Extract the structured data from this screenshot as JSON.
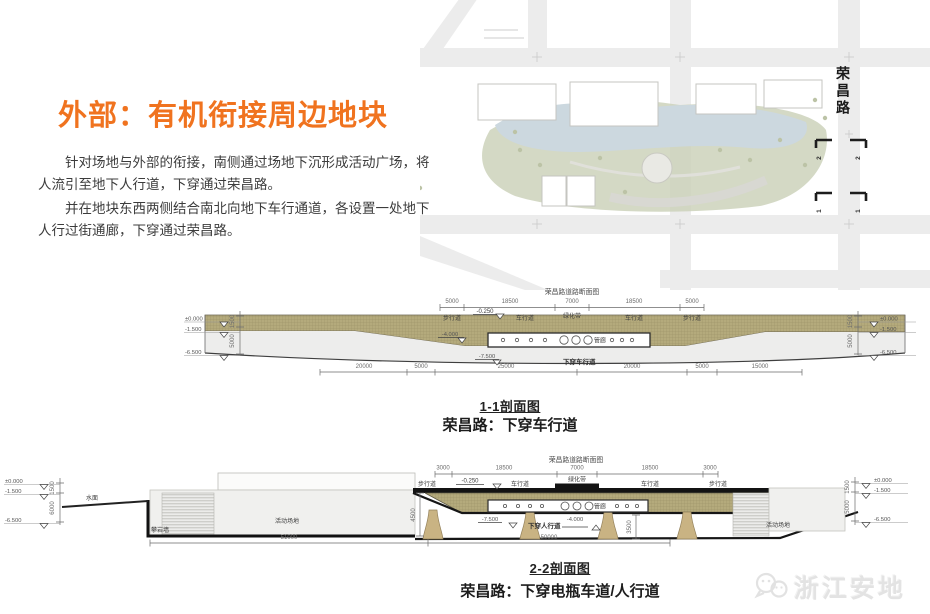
{
  "header": {
    "title": "外部：有机衔接周边地块",
    "para1": "针对场地与外部的衔接，南侧通过场地下沉形成活动广场，将人流引至地下人行道，下穿通过荣昌路。",
    "para2": "并在地块东西两侧结合南北向地下车行通道，各设置一处地下人行过街通廊，下穿通过荣昌路。"
  },
  "map": {
    "road_label": "荣昌路",
    "section_marker_2": "2",
    "section_marker_1": "1"
  },
  "section1": {
    "road_section_title": "荣昌路道路断面图",
    "top_dims": [
      "5000",
      "18500",
      "7000",
      "18500",
      "5000"
    ],
    "lanes": {
      "sidewalk_l": "步行道",
      "carriage_l": "车行道",
      "green": "绿化带",
      "carriage_r": "车行道",
      "sidewalk_r": "步行道"
    },
    "elev": {
      "zero": "±0.000",
      "m15": "-1.500",
      "m65": "-6.500",
      "m025": "-0.250",
      "m4": "-4.000",
      "m75": "-7.500"
    },
    "vdims": {
      "d1500": "1500",
      "d5000": "5000"
    },
    "gallery": "管廊",
    "underpass": "下穿车行道",
    "bottom_dims": [
      "20000",
      "5000",
      "25000",
      "20000",
      "5000",
      "15000"
    ],
    "caption_no": "1-1剖面图",
    "caption": "荣昌路：下穿车行道"
  },
  "section2": {
    "road_section_title": "荣昌路道路断面图",
    "top_dims": [
      "3000",
      "18500",
      "7000",
      "18500",
      "3000"
    ],
    "lanes": {
      "sidewalk_l": "步行道",
      "carriage_l": "车行道",
      "green": "绿化带",
      "carriage_r": "车行道",
      "sidewalk_r": "步行道"
    },
    "elev": {
      "zero": "±0.000",
      "m15": "-1.500",
      "m65": "-6.500",
      "m025": "-0.250",
      "m4": "-4.000",
      "m75": "-7.500"
    },
    "vdims": {
      "d1500": "1500",
      "d6000": "6000",
      "d5000": "5000",
      "d4500": "4500",
      "d3500": "3500"
    },
    "water": "水面",
    "climb_wall": "攀岩墙",
    "plaza_left": "活动场地",
    "plaza_right": "活动场地",
    "gallery": "管廊",
    "underpass": "下穿人行道",
    "bottom_dims": [
      "51000",
      "50000"
    ],
    "caption_no": "2-2剖面图",
    "caption": "荣昌路：下穿电瓶车道/人行道"
  },
  "logo": {
    "name": "浙江安地"
  },
  "colors": {
    "accent": "#f0731f",
    "earth": "#b4aa7c",
    "pier": "#c9b383",
    "lake": "#ccd8df",
    "green": "#cdd2bb"
  }
}
